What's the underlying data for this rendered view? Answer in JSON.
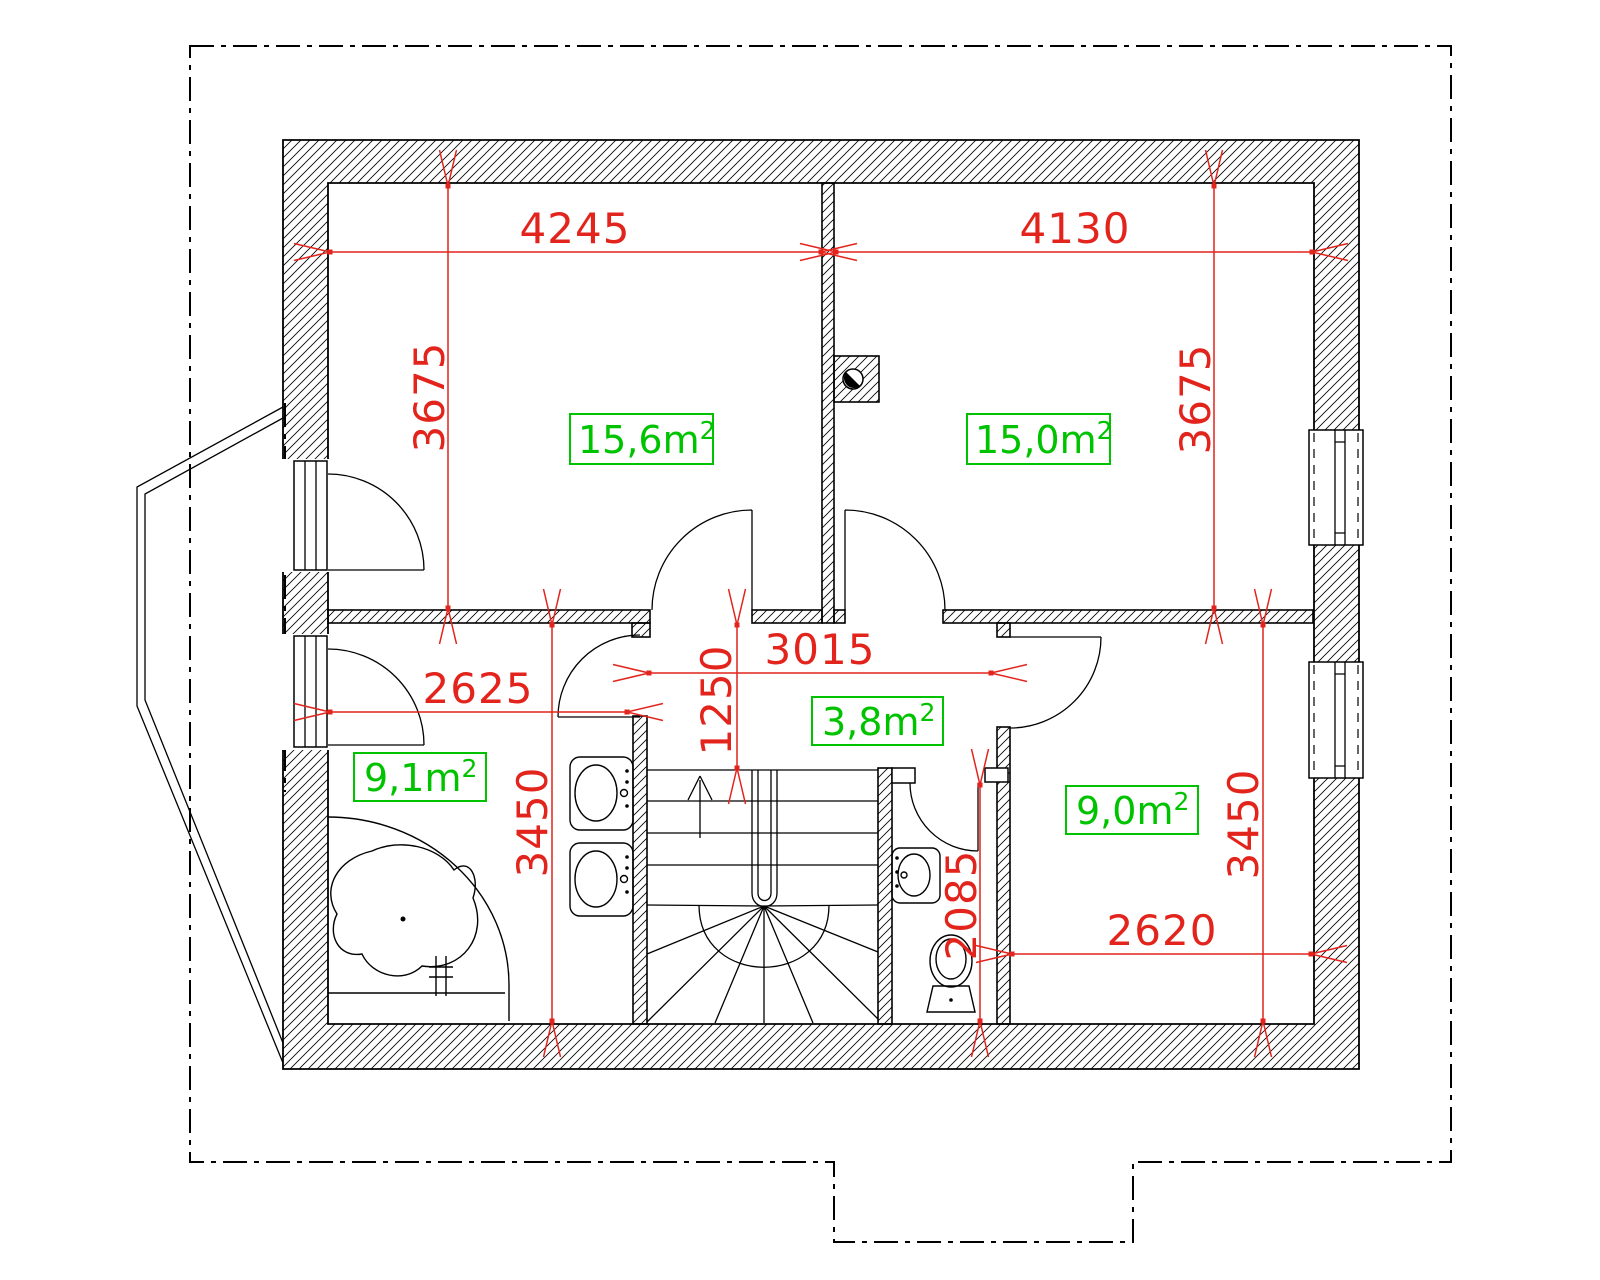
{
  "colors": {
    "dimension_red": "#e2241c",
    "area_green": "#00c300"
  },
  "rooms": [
    {
      "name": "bedroom-left",
      "value": "15,6",
      "unit": "m",
      "sup": "2"
    },
    {
      "name": "bedroom-right",
      "value": "15,0",
      "unit": "m",
      "sup": "2"
    },
    {
      "name": "hall",
      "value": "3,8",
      "unit": "m",
      "sup": "2"
    },
    {
      "name": "bathroom",
      "value": "9,1",
      "unit": "m",
      "sup": "2"
    },
    {
      "name": "room-bottom-right",
      "value": "9,0",
      "unit": "m",
      "sup": "2"
    }
  ],
  "dimensions": [
    {
      "name": "bedroom-left-width",
      "value": "4245"
    },
    {
      "name": "bedroom-right-width",
      "value": "4130"
    },
    {
      "name": "bedroom-left-height",
      "value": "3675"
    },
    {
      "name": "bedroom-right-height",
      "value": "3675"
    },
    {
      "name": "hall-width",
      "value": "3015"
    },
    {
      "name": "hall-depth",
      "value": "1250"
    },
    {
      "name": "bathroom-width",
      "value": "2625"
    },
    {
      "name": "bathroom-height",
      "value": "3450"
    },
    {
      "name": "wc-height",
      "value": "2085"
    },
    {
      "name": "room-bottom-right-width",
      "value": "2620"
    },
    {
      "name": "room-bottom-right-height",
      "value": "3450"
    }
  ]
}
